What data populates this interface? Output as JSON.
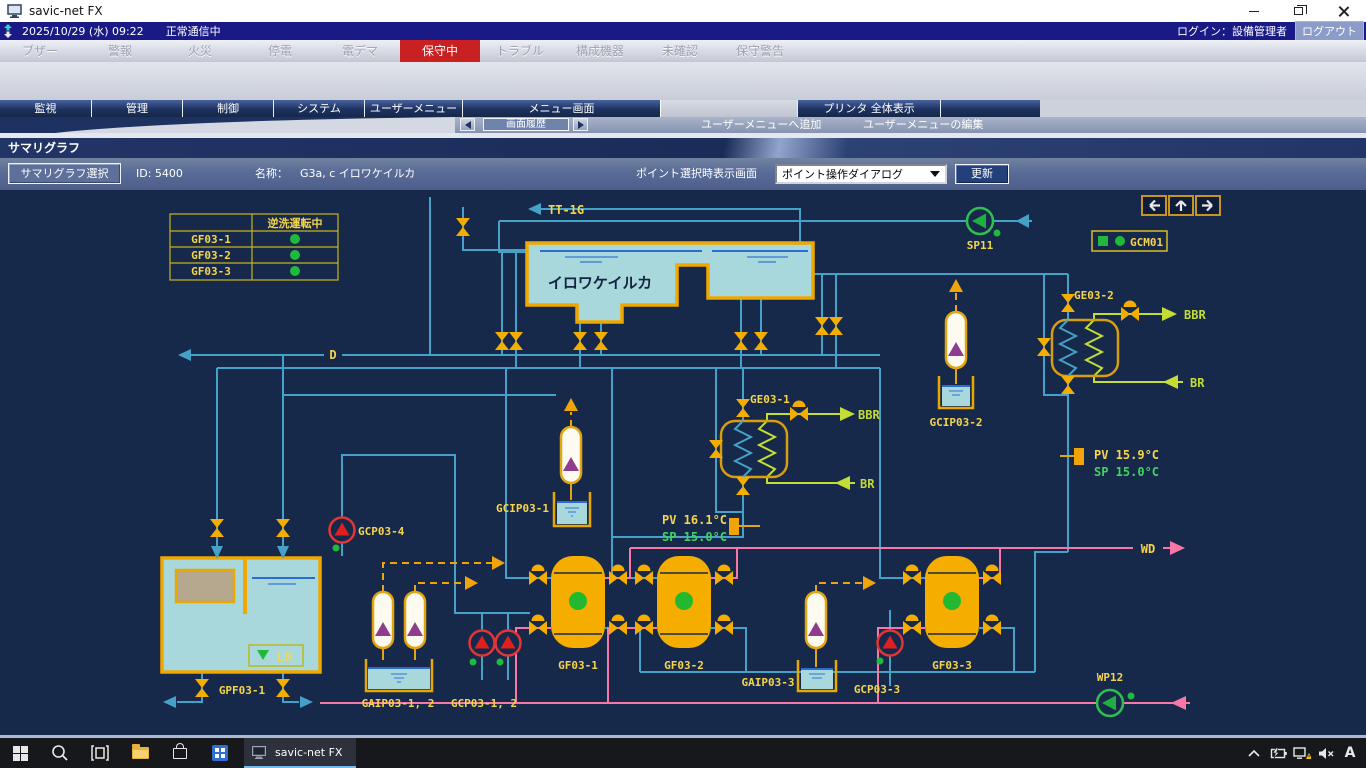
{
  "titlebar": {
    "title": "savic-net FX"
  },
  "statusbar": {
    "datetime": "2025/10/29 (水) 09:22",
    "comm_status": "正常通信中",
    "login": "ログイン：設備管理者",
    "logout": "ログアウト"
  },
  "alarm_tabs": [
    {
      "label": "ブザー",
      "active": false
    },
    {
      "label": "警報",
      "active": false
    },
    {
      "label": "火災",
      "active": false
    },
    {
      "label": "停電",
      "active": false
    },
    {
      "label": "電デマ",
      "active": false
    },
    {
      "label": "保守中",
      "active": true
    },
    {
      "label": "トラブル",
      "active": false
    },
    {
      "label": "構成機器",
      "active": false
    },
    {
      "label": "未確認",
      "active": false
    },
    {
      "label": "保守警告",
      "active": false
    }
  ],
  "menu_tabs": [
    "監視",
    "管理",
    "制御",
    "システム",
    "ユーザーメニュー",
    "メニュー画面"
  ],
  "printer_tab": "プリンタ 全体表示",
  "nav_row": {
    "history": "画面履歴",
    "add_user_menu": "ユーザーメニューへ追加",
    "edit_user_menu": "ユーザーメニューの編集"
  },
  "page": {
    "title": "サマリグラフ"
  },
  "toolbar": {
    "select_button": "サマリグラフ選択",
    "id_label": "ID: 5400",
    "name_label": "名称：",
    "name_value": "G3a, c イロワケイルカ",
    "point_display_label": "ポイント選択時表示画面",
    "point_dialog_option": "ポイント操作ダイアログ",
    "update_button": "更新"
  },
  "diagram": {
    "status_table": {
      "header": "逆洗運転中",
      "rows": [
        "GF03-1",
        "GF03-2",
        "GF03-3"
      ]
    },
    "labels": {
      "tt1g": "TT-1G",
      "pool": "イロワケイルカ",
      "d_line": "D",
      "lo": "LO",
      "gpf03_1": "GPF03-1",
      "gcp03_4": "GCP03-4",
      "gaip03_12": "GAIP03-1, 2",
      "gcp03_12": "GCP03-1, 2",
      "gcip03_1": "GCIP03-1",
      "gf03_1": "GF03-1",
      "gf03_2": "GF03-2",
      "gf03_3": "GF03-3",
      "gaip03_3": "GAIP03-3",
      "gcp03_3": "GCP03-3",
      "gcip03_2": "GCIP03-2",
      "ge03_1": "GE03-1",
      "ge03_2": "GE03-2",
      "bbr": "BBR",
      "br": "BR",
      "sp11": "SP11",
      "gcm01": "GCM01",
      "wd": "WD",
      "wp12": "WP12"
    },
    "temps": {
      "gf_pv": "PV 16.1°C",
      "gf_sp": "SP 15.0°C",
      "ge2_pv": "PV 15.9°C",
      "ge2_sp": "SP 15.0°C"
    }
  },
  "taskbar": {
    "app": "savic-net FX",
    "ime": "A"
  },
  "colors": {
    "pipe_cyan": "#45a1c6",
    "pipe_pink": "#f877a6",
    "equip_orange": "#f5ad00",
    "label_yellow": "#f7d54a",
    "line_yellow_green": "#c3dd35",
    "status_green": "#1fba3c",
    "alarm_red": "#c92121"
  }
}
